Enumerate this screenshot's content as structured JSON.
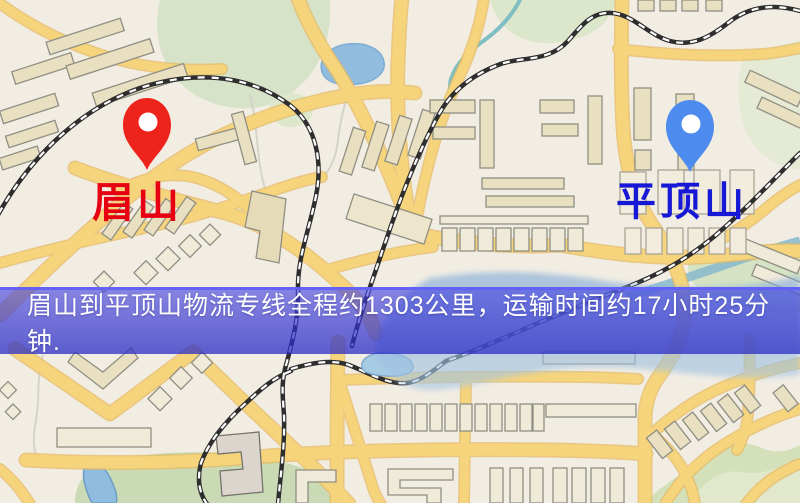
{
  "banner": {
    "text": "眉山到平顶山物流专线全程约1303公里，运输时间约17小时25分钟.",
    "origin": "眉山",
    "destination": "平顶山",
    "distance": "1303公里",
    "duration": "17小时25分钟",
    "overlay_color": "#3e3ee0",
    "text_color": "#ffffff"
  },
  "markers": {
    "origin": {
      "label": "眉山",
      "label_color": "#e60012",
      "pin_color": "#ed241c"
    },
    "destination": {
      "label": "平顶山",
      "label_color": "#1717d6",
      "pin_color": "#4e8bef"
    }
  },
  "map_legend_colors": {
    "background": "#f2ede3",
    "road": "#f5d47c",
    "park": "#d7e3c8",
    "water": "#8fbcdf",
    "railway": "#2e2e2e"
  }
}
